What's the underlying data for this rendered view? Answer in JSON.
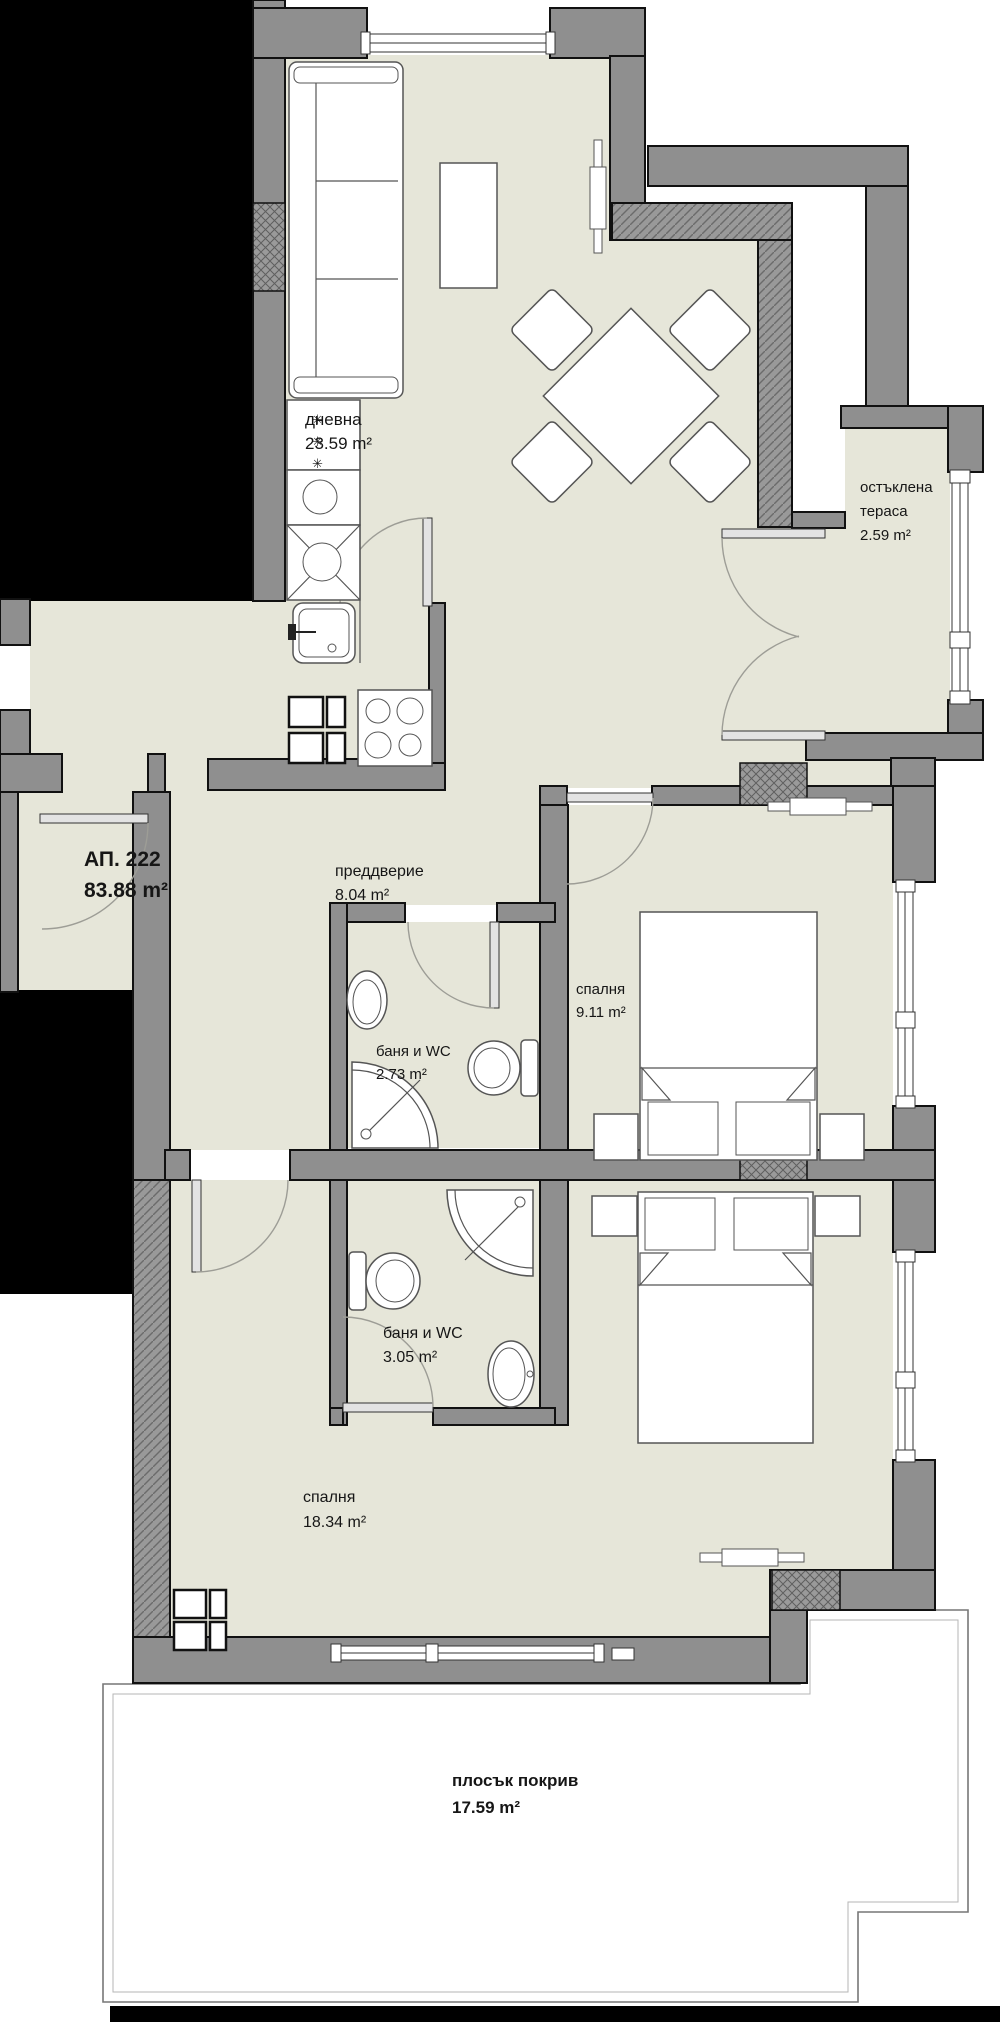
{
  "apartment": {
    "number": "АП. 222",
    "area": "83.88 m²"
  },
  "rooms": [
    {
      "id": "living",
      "label": "дневна",
      "area": "23.59 m²"
    },
    {
      "id": "terrace",
      "line1": "остъклена",
      "line2": "тераса",
      "area": "2.59 m²"
    },
    {
      "id": "hallway",
      "label": "преддверие",
      "area": "8.04 m²"
    },
    {
      "id": "bedroom1",
      "label": "спалня",
      "area": "9.11 m²"
    },
    {
      "id": "bath1",
      "label": "баня и WC",
      "area": "2.73 m²"
    },
    {
      "id": "bath2",
      "label": "баня и WC",
      "area": "3.05 m²"
    },
    {
      "id": "bedroom2",
      "label": "спалня",
      "area": "18.34 m²"
    },
    {
      "id": "roof",
      "label": "плосък покрив",
      "area": "17.59 m²"
    }
  ],
  "symbols": {
    "freezer": "✳"
  },
  "colors": {
    "floor": "#e6e6d9",
    "wall": "#8f8f8f",
    "mask": "#000000",
    "roof": "#ffffff"
  }
}
